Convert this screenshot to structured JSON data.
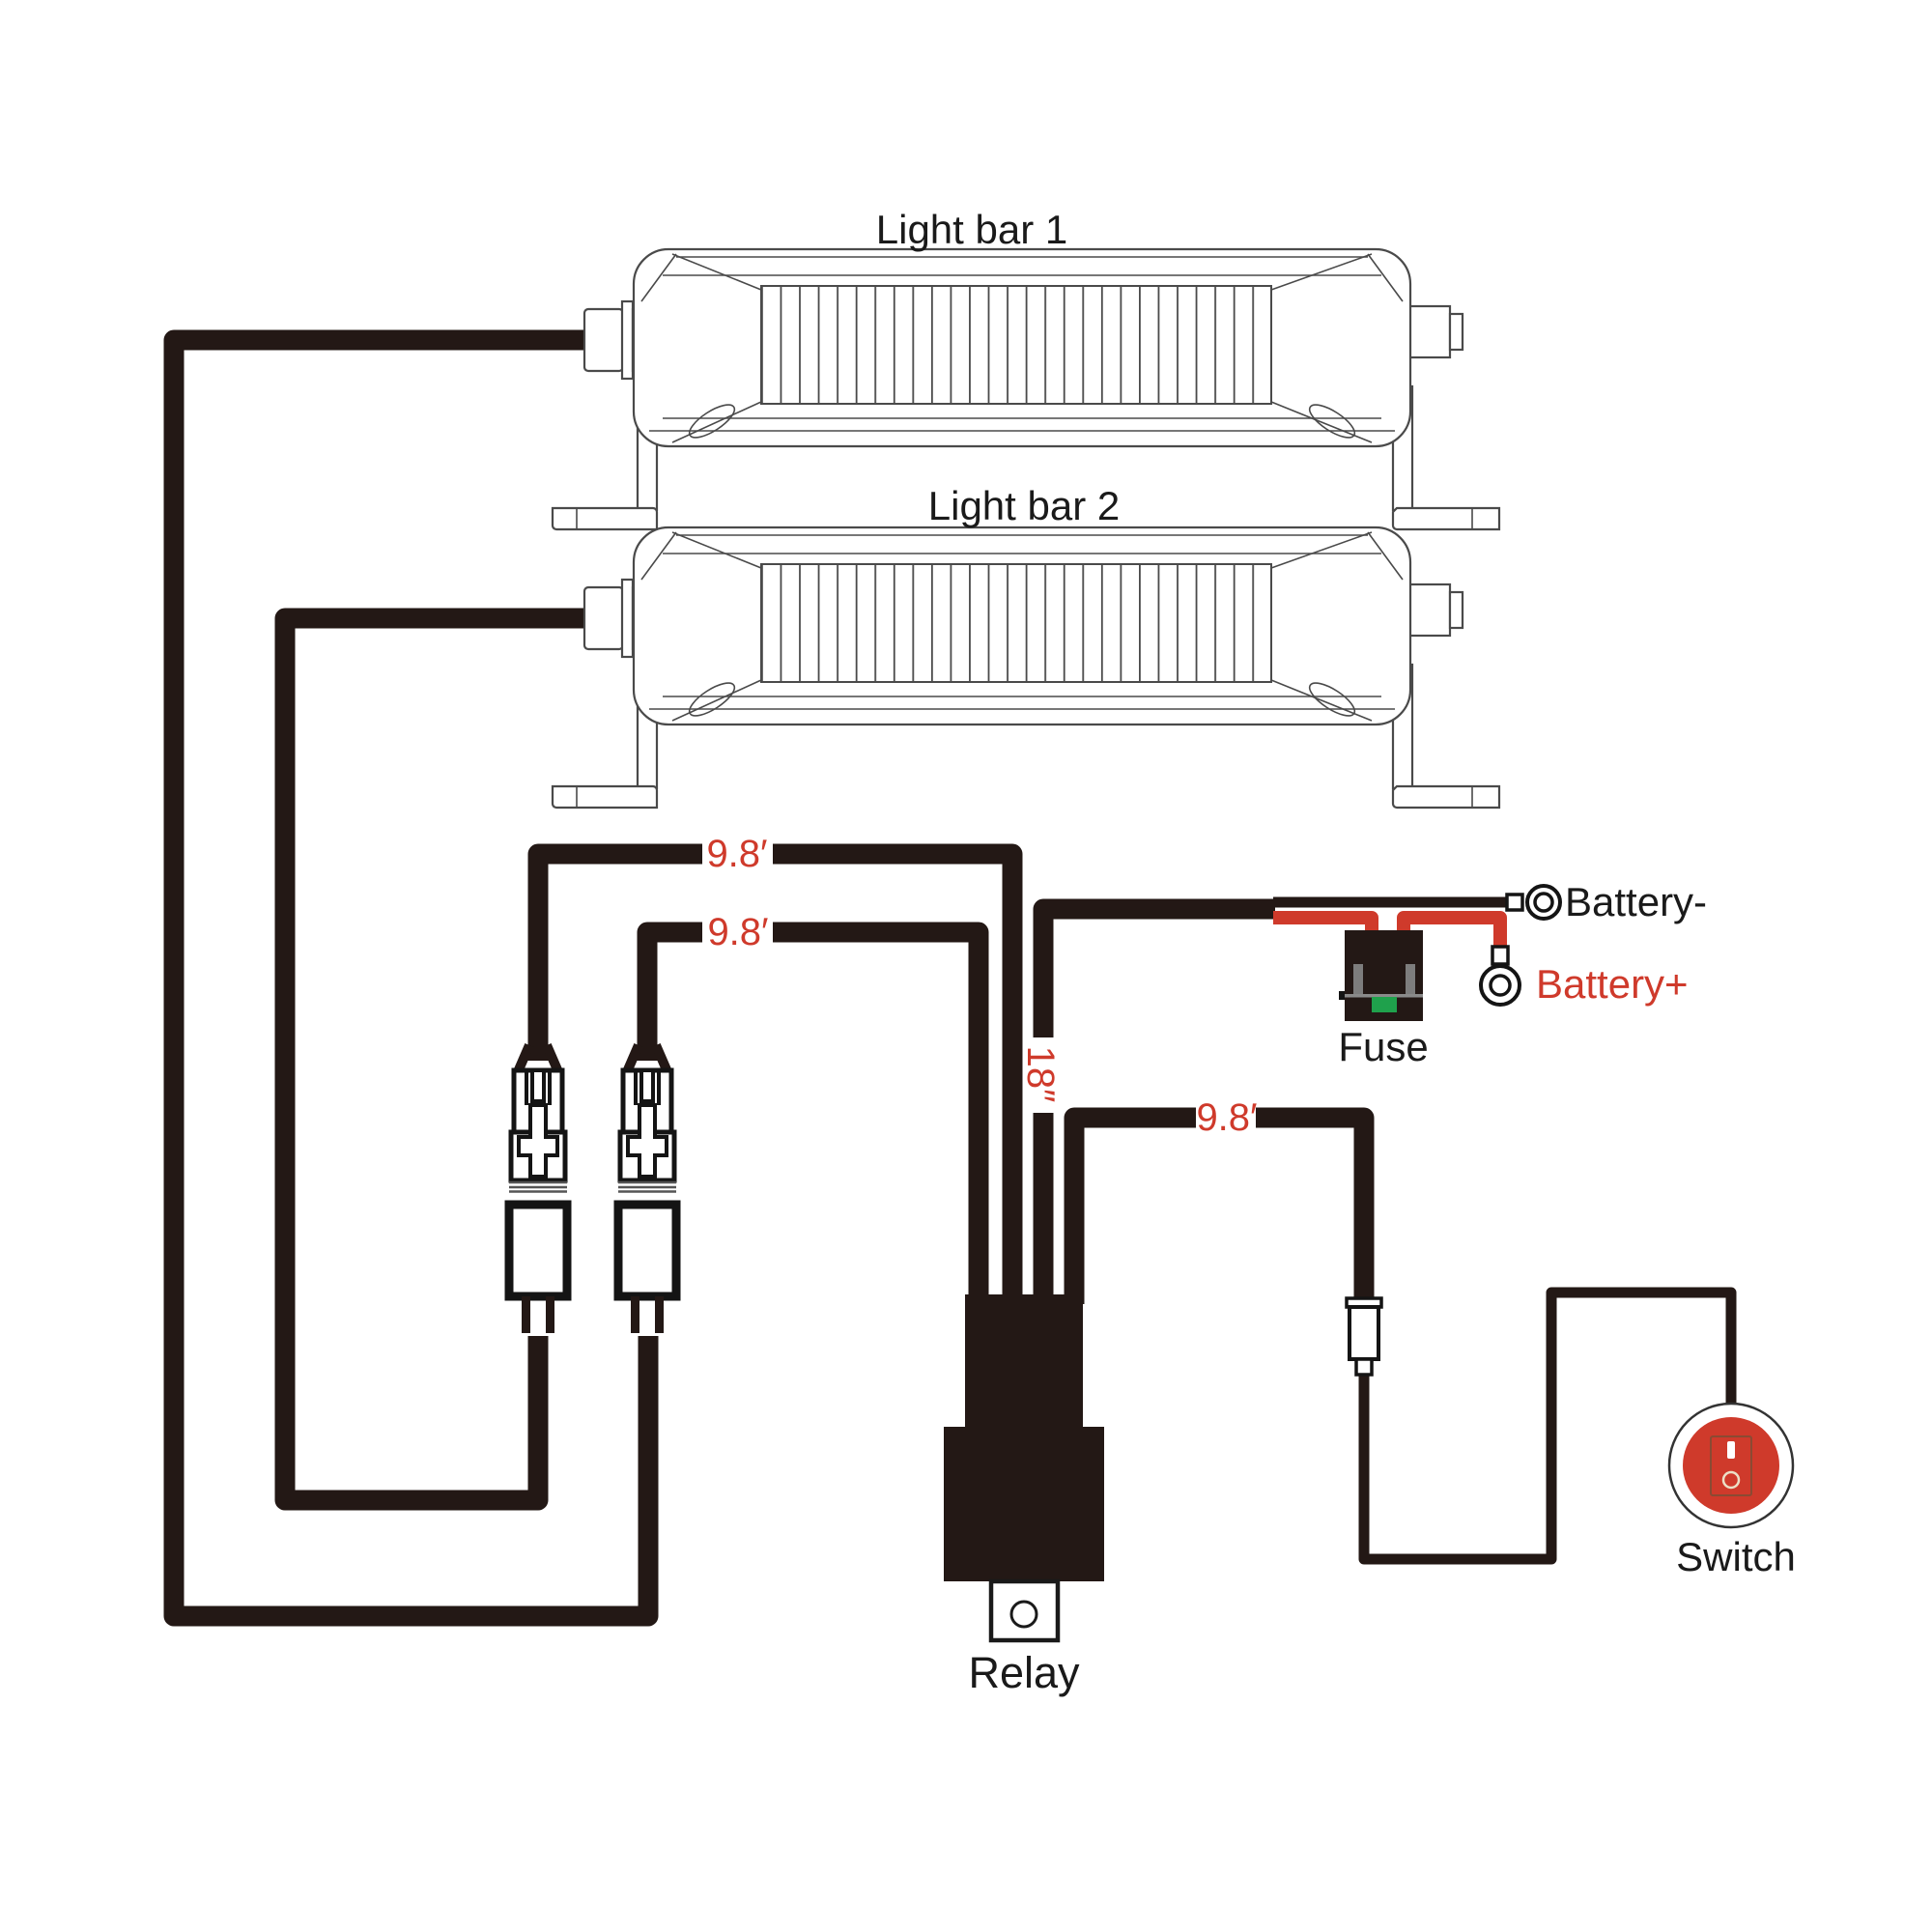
{
  "diagram": {
    "light_bar_1": {
      "label": "Light bar 1"
    },
    "light_bar_2": {
      "label": "Light bar 2"
    },
    "relay": {
      "label": "Relay"
    },
    "fuse": {
      "label": "Fuse"
    },
    "switch": {
      "label": "Switch"
    },
    "battery_negative": {
      "label": "Battery-"
    },
    "battery_positive": {
      "label": "Battery+"
    },
    "wire_lengths": {
      "lightbar1_lead": "9.8′",
      "lightbar2_lead": "9.8′",
      "relay_to_battery": "18″",
      "switch_lead": "9.8′"
    }
  },
  "colors": {
    "wire": "#231815",
    "accent_red": "#cf3a2b",
    "outline_gray": "#4a4a4a",
    "fuse_green": "#1fa14c",
    "metal_gray": "#7d7d7d"
  }
}
